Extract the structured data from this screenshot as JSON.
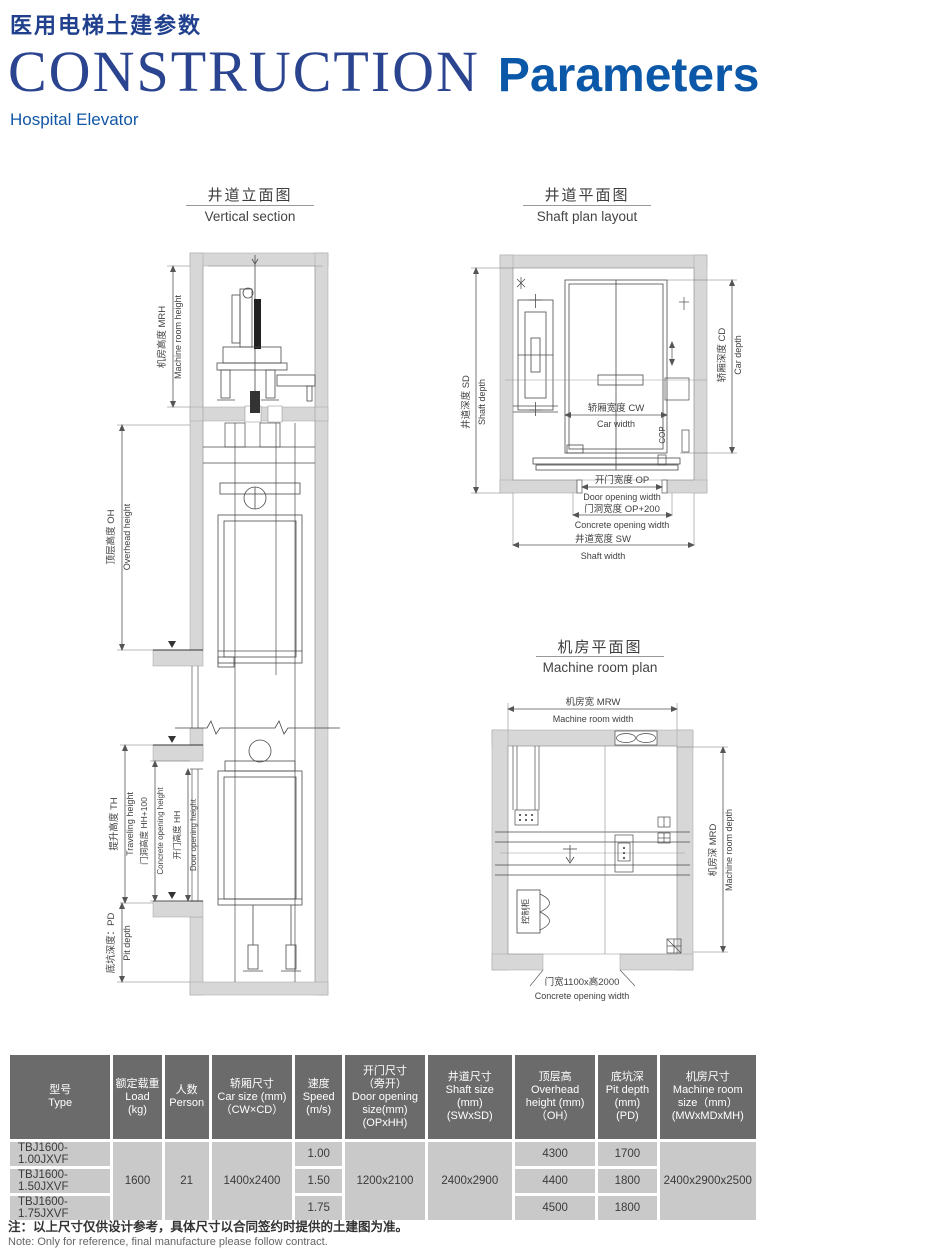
{
  "header": {
    "title_zh": "医用电梯土建参数",
    "title_serif": "CONSTRUCTION",
    "title_bold": "Parameters",
    "subtitle": "Hospital Elevator"
  },
  "colors": {
    "title_blue_dark": "#20408e",
    "title_blue_bright": "#0b58a8",
    "table_header_bg": "#6b6b6b",
    "table_row_bg": "#c9c9c9",
    "wall_gray": "#d7d7d7"
  },
  "diagrams": {
    "vertical_section": {
      "title_zh": "井道立面图",
      "title_en": "Vertical section",
      "labels": {
        "mrh_zh": "机房高度 MRH",
        "mrh_en": "Machine room height",
        "oh_zh": "顶层高度 OH",
        "oh_en": "Overhead height",
        "th_zh": "提升高度 TH",
        "th_en": "Traveling height",
        "hh100_zh": "门洞高度 HH+100",
        "hh100_en": "Concrete opening height",
        "hh_zh": "开门高度 HH",
        "hh_en": "Door opening height",
        "pd_zh": "底坑深度：PD",
        "pd_en": "Pit depth"
      }
    },
    "shaft_plan": {
      "title_zh": "井道平面图",
      "title_en": "Shaft plan layout",
      "labels": {
        "sd_zh": "井道深度 SD",
        "sd_en": "Shaft depth",
        "cd_zh": "轿厢深度 CD",
        "cd_en": "Car depth",
        "cw_zh": "轿厢宽度 CW",
        "cw_en": "Car width",
        "op_zh": "开门宽度 OP",
        "op_en": "Door opening width",
        "op200_zh": "门洞宽度 OP+200",
        "op200_en": "Concrete opening width",
        "sw_zh": "井道宽度 SW",
        "sw_en": "Shaft width",
        "cop": "COP"
      }
    },
    "machine_room_plan": {
      "title_zh": "机房平面图",
      "title_en": "Machine room plan",
      "labels": {
        "mrw_zh": "机房宽 MRW",
        "mrw_en": "Machine room width",
        "mrd_zh": "机房深 MRD",
        "mrd_en": "Machine room depth",
        "cabinet": "控制柜",
        "door_zh": "门宽1100x高2000",
        "door_en": "Concrete opening width"
      }
    }
  },
  "table": {
    "headers": [
      [
        "型号",
        "Type"
      ],
      [
        "额定载重",
        "Load",
        "(kg)"
      ],
      [
        "人数",
        "Person"
      ],
      [
        "轿厢尺寸",
        "Car size (mm)",
        "（CW×CD）"
      ],
      [
        "速度",
        "Speed",
        "(m/s)"
      ],
      [
        "开门尺寸",
        "（旁开）",
        "Door opening",
        "size(mm)",
        "(OPxHH)"
      ],
      [
        "井道尺寸",
        "Shaft size",
        "(mm)",
        "(SWxSD)"
      ],
      [
        "顶层高",
        "Overhead",
        "height (mm)",
        "（OH）"
      ],
      [
        "底坑深",
        "Pit depth",
        "(mm)",
        "(PD)"
      ],
      [
        "机房尺寸",
        "Machine room",
        "size（mm）",
        "(MWxMDxMH)"
      ]
    ],
    "rows": {
      "types": [
        "TBJ1600-1.00JXVF",
        "TBJ1600-1.50JXVF",
        "TBJ1600-1.75JXVF"
      ],
      "speeds": [
        "1.00",
        "1.50",
        "1.75"
      ],
      "overhead": [
        "4300",
        "4400",
        "4500"
      ],
      "pit": [
        "1700",
        "1800",
        "1800"
      ],
      "load": "1600",
      "person": "21",
      "car_size": "1400x2400",
      "door_opening": "1200x2100",
      "shaft_size": "2400x2900",
      "machine_room": "2400x2900x2500"
    }
  },
  "notes": {
    "zh": "注：以上尺寸仅供设计参考，具体尺寸以合同签约时提供的土建图为准。",
    "en": "Note: Only for reference, final manufacture please follow contract."
  }
}
